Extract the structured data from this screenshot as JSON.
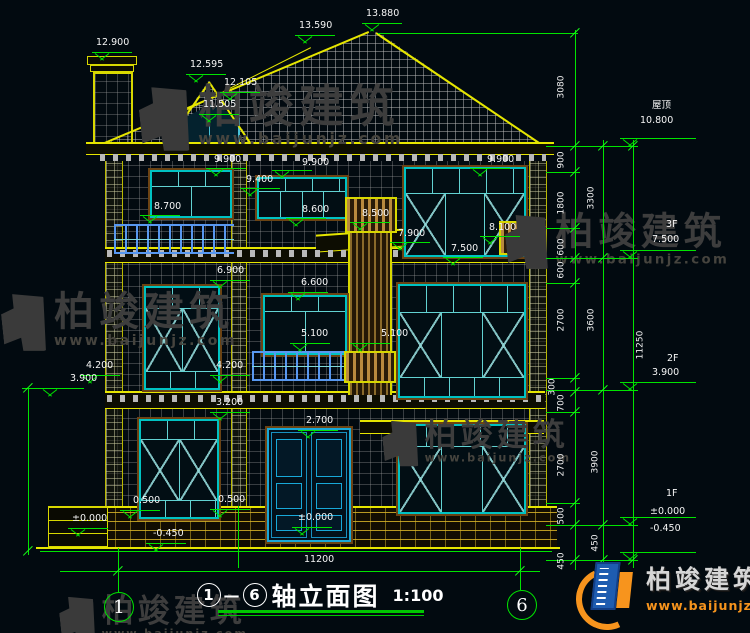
{
  "colors": {
    "background": "#020a10",
    "dim_green": "#00e400",
    "outline_yellow": "#e6e600",
    "window_teal": "#00c2c2",
    "rail_blue": "#5898f0",
    "text_white": "#f5f5f5",
    "logo_blue": "#1e5cb0",
    "logo_orange": "#f7941d",
    "watermark_gray": "#3d3d3d"
  },
  "title": {
    "axis_from": "1",
    "dash": "—",
    "axis_to": "6",
    "name": "轴立面图",
    "scale": "1:100"
  },
  "axes": {
    "left": "1",
    "right": "6"
  },
  "logo": {
    "name": "柏竣建筑",
    "url": "www.baijunjz.com"
  },
  "watermark": {
    "name": "柏竣建筑",
    "url": "www.baijunjz.com"
  },
  "annotations": [
    {
      "t": "12.900",
      "x": 96,
      "y": 38,
      "lm": [
        92,
        52,
        40
      ]
    },
    {
      "t": "13.590",
      "x": 299,
      "y": 21,
      "lm": [
        295,
        35,
        40
      ]
    },
    {
      "t": "13.880",
      "x": 366,
      "y": 9,
      "lm": [
        362,
        23,
        40
      ]
    },
    {
      "t": "12.595",
      "x": 190,
      "y": 60,
      "lm": [
        186,
        74,
        40
      ]
    },
    {
      "t": "12.105",
      "x": 224,
      "y": 78,
      "lm": [
        220,
        92,
        40
      ]
    },
    {
      "t": "11.505",
      "x": 203,
      "y": 100,
      "lm": [
        199,
        114,
        40
      ]
    },
    {
      "t": "9.900",
      "x": 214,
      "y": 155,
      "lm": [
        206,
        168,
        40
      ]
    },
    {
      "t": "9.900",
      "x": 302,
      "y": 158,
      "lm": [
        272,
        170,
        40
      ]
    },
    {
      "t": "9.900",
      "x": 487,
      "y": 155,
      "lm": [
        470,
        168,
        40
      ]
    },
    {
      "t": "9.400",
      "x": 246,
      "y": 175,
      "lm": [
        240,
        188,
        40
      ]
    },
    {
      "t": "8.700",
      "x": 154,
      "y": 202,
      "lm": [
        140,
        215,
        40
      ]
    },
    {
      "t": "8.600",
      "x": 302,
      "y": 205,
      "lm": [
        286,
        218,
        40
      ]
    },
    {
      "t": "8.500",
      "x": 362,
      "y": 209,
      "lm": [
        350,
        222,
        40
      ]
    },
    {
      "t": "8.100",
      "x": 489,
      "y": 223,
      "lm": [
        480,
        236,
        40
      ]
    },
    {
      "t": "7.900",
      "x": 398,
      "y": 229,
      "lm": [
        390,
        242,
        40
      ]
    },
    {
      "t": "7.500",
      "x": 451,
      "y": 244,
      "lm": [
        443,
        257,
        40
      ]
    },
    {
      "t": "6.900",
      "x": 217,
      "y": 266,
      "lm": [
        210,
        280,
        40
      ]
    },
    {
      "t": "6.600",
      "x": 301,
      "y": 278,
      "lm": [
        288,
        292,
        40
      ]
    },
    {
      "t": "5.100",
      "x": 301,
      "y": 329,
      "lm": [
        290,
        343,
        40
      ]
    },
    {
      "t": "5.100",
      "x": 381,
      "y": 329,
      "lm": [
        350,
        343,
        40
      ]
    },
    {
      "t": "4.200",
      "x": 86,
      "y": 361,
      "lm": [
        80,
        375,
        40
      ]
    },
    {
      "t": "4.200",
      "x": 216,
      "y": 361,
      "lm": [
        210,
        375,
        40
      ]
    },
    {
      "t": "3.900",
      "x": 70,
      "y": 374,
      "lm": [
        40,
        388,
        44
      ]
    },
    {
      "t": "3.200",
      "x": 216,
      "y": 398,
      "lm": [
        210,
        412,
        40
      ]
    },
    {
      "t": "2.700",
      "x": 306,
      "y": 416,
      "lm": [
        298,
        430,
        40
      ]
    },
    {
      "t": "0.500",
      "x": 133,
      "y": 496,
      "lm": [
        120,
        510,
        40
      ]
    },
    {
      "t": "0.500",
      "x": 218,
      "y": 495,
      "lm": [
        210,
        509,
        40
      ]
    },
    {
      "t": "±0.000",
      "x": 72,
      "y": 514,
      "lm": [
        68,
        528,
        40
      ]
    },
    {
      "t": "±0.000",
      "x": 298,
      "y": 513,
      "lm": [
        292,
        527,
        40
      ]
    },
    {
      "t": "-0.450",
      "x": 153,
      "y": 529,
      "lm": [
        146,
        543,
        40
      ]
    },
    {
      "t": "11200",
      "x": 304,
      "y": 555
    },
    {
      "t": "屋顶",
      "x": 652,
      "y": 101
    },
    {
      "t": "10.800",
      "x": 640,
      "y": 116,
      "lm": [
        620,
        138,
        76
      ]
    },
    {
      "t": "3F",
      "x": 666,
      "y": 220
    },
    {
      "t": "7.500",
      "x": 652,
      "y": 235,
      "lm": [
        620,
        250,
        76
      ]
    },
    {
      "t": "2F",
      "x": 667,
      "y": 354
    },
    {
      "t": "3.900",
      "x": 652,
      "y": 368,
      "lm": [
        620,
        382,
        76
      ]
    },
    {
      "t": "1F",
      "x": 666,
      "y": 489
    },
    {
      "t": "±0.000",
      "x": 650,
      "y": 507,
      "lm": [
        620,
        517,
        76
      ]
    },
    {
      "t": "-0.450",
      "x": 650,
      "y": 524,
      "lm": [
        620,
        552,
        76
      ]
    }
  ],
  "dim_labels": [
    {
      "t": "3080",
      "x": 562,
      "y": 87
    },
    {
      "t": "900",
      "x": 562,
      "y": 160
    },
    {
      "t": "1800",
      "x": 562,
      "y": 203
    },
    {
      "t": "3300",
      "x": 592,
      "y": 198
    },
    {
      "t": "600",
      "x": 562,
      "y": 247
    },
    {
      "t": "600",
      "x": 562,
      "y": 270
    },
    {
      "t": "2700",
      "x": 562,
      "y": 320
    },
    {
      "t": "3600",
      "x": 592,
      "y": 320
    },
    {
      "t": "300",
      "x": 553,
      "y": 387
    },
    {
      "t": "700",
      "x": 562,
      "y": 403
    },
    {
      "t": "2700",
      "x": 562,
      "y": 465
    },
    {
      "t": "3900",
      "x": 596,
      "y": 462
    },
    {
      "t": "500",
      "x": 562,
      "y": 516
    },
    {
      "t": "450",
      "x": 562,
      "y": 561
    },
    {
      "t": "450",
      "x": 596,
      "y": 543
    },
    {
      "t": "11250",
      "x": 641,
      "y": 345
    }
  ]
}
